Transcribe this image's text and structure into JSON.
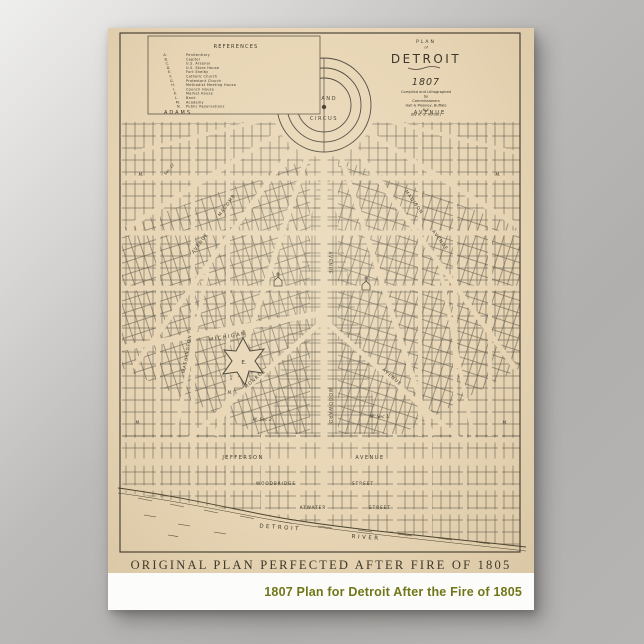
{
  "product": {
    "caption": "1807 Plan for Detroit After the Fire of 1805"
  },
  "poster": {
    "caption": "ORIGINAL PLAN PERFECTED AFTER FIRE OF 1805"
  },
  "map": {
    "title": {
      "plan": "PLAN",
      "of": "of",
      "name": "DETROIT",
      "year": "1807",
      "credits": [
        "Compiled and Lithographed",
        "by",
        "Commissioners",
        "Hall & Mooney, Buffalo",
        "N.Y.",
        "(By A. G. Horner)"
      ]
    },
    "legend": {
      "title": "REFERENCES",
      "letters": [
        "A.",
        "B.",
        "C.",
        "D.",
        "E.",
        "F.",
        "G.",
        "H.",
        "I.",
        "K.",
        "L.",
        "M.",
        "N."
      ],
      "entries": [
        "Penitentiary",
        "Capitol",
        "U.S. Arsenal",
        "U.S. Store House",
        "Fort Shelby",
        "Catholic Church",
        "Protestant Church",
        "Methodist Meeting House",
        "Council House",
        "Market House",
        "Bank",
        "Academy",
        "Public Reservations"
      ]
    },
    "labels": {
      "grand": "GRAND",
      "circus": "CIRCUS",
      "adams": "ADAMS",
      "adams_av": "AVENUE",
      "macomb": "MACOMB",
      "macomb_av": "AVENUE",
      "madison": "MADISON",
      "madison_av": "AVENUE",
      "michigan": "MICHIGAN",
      "monroe": "MONROE",
      "monroe_av": "AVENUE",
      "washington": "WASHINGTON",
      "woodward": "WOODWARD",
      "woodward_av": "AVENUE",
      "jefferson": "JEFFERSON",
      "jefferson_av": "AVENUE",
      "woodbridge": "WOODBRIDGE",
      "woodbridge_st": "STREET",
      "atwater": "ATWATER",
      "atwater_st": "STREET",
      "river1": "DETROIT",
      "river2": "RIVER",
      "sec2": "M. Sec 2.",
      "sec1": "M. Sec 1.",
      "sec12": "Sec. 12",
      "m_mark": "M.",
      "fort_letter": "E."
    }
  },
  "colors": {
    "paper": "#e8d6b6",
    "ink": "#3b3629",
    "caption_green": "#717619",
    "background_gray": "#b1afad",
    "poster_white": "#fcfcfa"
  }
}
